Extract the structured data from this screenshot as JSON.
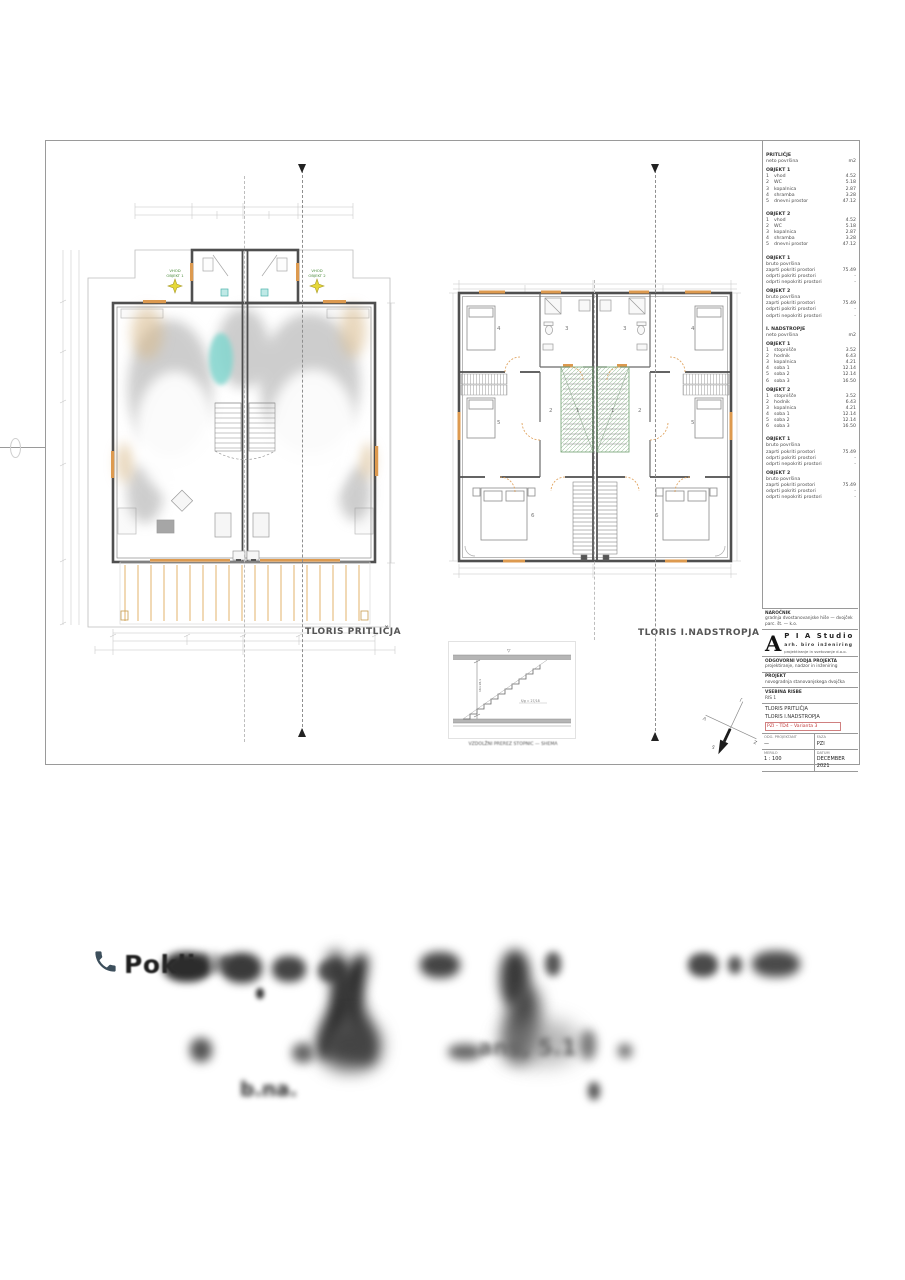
{
  "sheet": {
    "ground": {
      "title": "TLORIS PRITLIČJA",
      "entry1": "VHOD",
      "entry1b": "OBJEKT 1",
      "entry2": "VHOD",
      "entry2b": "OBJEKT 2"
    },
    "upper": {
      "title": "TLORIS I.NADSTROPJA",
      "rooms": [
        "1",
        "2",
        "3",
        "4",
        "5",
        "6"
      ]
    },
    "stair_detail": {
      "caption": "VZDOLŽNI PREREZ STOPNIC — SHEMA",
      "note": "š/g = 27/18",
      "dim_label": "16×18,1",
      "level_top": "▽"
    },
    "compass": {
      "n": "S",
      "e": "V",
      "s": "J",
      "w": "Z"
    }
  },
  "legend": {
    "sections": [
      {
        "lines": [
          {
            "t": "PRITLIČJE"
          },
          {
            "l": "neto površina",
            "v": "m2"
          },
          {
            "t": "OBJEKT 1"
          },
          {
            "n": "1",
            "l": "vhod",
            "v": "4.52"
          },
          {
            "n": "2",
            "l": "WC",
            "v": "5.18"
          },
          {
            "n": "3",
            "l": "kopalnica",
            "v": "2.87"
          },
          {
            "n": "4",
            "l": "shramba",
            "v": "3.28"
          },
          {
            "n": "5",
            "l": "dnevni prostor",
            "v": "47.12"
          }
        ]
      },
      {
        "lines": [
          {
            "t": "OBJEKT 2"
          },
          {
            "n": "1",
            "l": "vhod",
            "v": "4.52"
          },
          {
            "n": "2",
            "l": "WC",
            "v": "5.18"
          },
          {
            "n": "3",
            "l": "kopalnica",
            "v": "2.87"
          },
          {
            "n": "4",
            "l": "shramba",
            "v": "3.28"
          },
          {
            "n": "5",
            "l": "dnevni prostor",
            "v": "47.12"
          }
        ]
      },
      {
        "lines": [
          {
            "t": "OBJEKT 1"
          },
          {
            "l": "bruto površina"
          },
          {
            "l": "zaprti pokriti prostori",
            "v": "75.49"
          },
          {
            "l": "odprti pokriti prostori",
            "v": "-"
          },
          {
            "l": "odprti nepokriti prostori",
            "v": "-"
          },
          {
            "t": "OBJEKT 2"
          },
          {
            "l": "bruto površina"
          },
          {
            "l": "zaprti pokriti prostori",
            "v": "75.49"
          },
          {
            "l": "odprti pokriti prostori",
            "v": "-"
          },
          {
            "l": "odprti nepokriti prostori",
            "v": "-"
          }
        ]
      },
      {
        "lines": [
          {
            "t": "I. NADSTROPJE"
          },
          {
            "l": "neto površina",
            "v": "m2"
          },
          {
            "t": "OBJEKT 1"
          },
          {
            "n": "1",
            "l": "stopnišče",
            "v": "3.52"
          },
          {
            "n": "2",
            "l": "hodnik",
            "v": "6.43"
          },
          {
            "n": "3",
            "l": "kopalnica",
            "v": "4.21"
          },
          {
            "n": "4",
            "l": "soba 1",
            "v": "12.14"
          },
          {
            "n": "5",
            "l": "soba 2",
            "v": "12.14"
          },
          {
            "n": "6",
            "l": "soba 3",
            "v": "16.50"
          },
          {
            "t": "OBJEKT 2"
          },
          {
            "n": "1",
            "l": "stopnišče",
            "v": "3.52"
          },
          {
            "n": "2",
            "l": "hodnik",
            "v": "6.43"
          },
          {
            "n": "3",
            "l": "kopalnica",
            "v": "4.21"
          },
          {
            "n": "4",
            "l": "soba 1",
            "v": "12.14"
          },
          {
            "n": "5",
            "l": "soba 2",
            "v": "12.14"
          },
          {
            "n": "6",
            "l": "soba 3",
            "v": "16.50"
          }
        ]
      },
      {
        "lines": [
          {
            "t": "OBJEKT 1"
          },
          {
            "l": "bruto površina"
          },
          {
            "l": "zaprti pokriti prostori",
            "v": "75.49"
          },
          {
            "l": "odprti pokriti prostori",
            "v": "-"
          },
          {
            "l": "odprti nepokriti prostori",
            "v": "-"
          },
          {
            "t": "OBJEKT 2"
          },
          {
            "l": "bruto površina"
          },
          {
            "l": "zaprti pokriti prostori",
            "v": "75.49"
          },
          {
            "l": "odprti pokriti prostori",
            "v": "-"
          },
          {
            "l": "odprti nepokriti prostori",
            "v": "-"
          }
        ]
      }
    ]
  },
  "titleblock": {
    "blocks": [
      {
        "lines": [
          "NAROČNIK",
          "gradnja dvostanovanjske hiše — dvojček",
          "parc. št. — k.o."
        ]
      },
      {
        "logo": true,
        "letter": "A",
        "name": "P I A  Studio",
        "sub": "arh. biro inženiring",
        "line2": "projektiranje in svetovanje d.o.o."
      },
      {
        "lines": [
          "ODGOVORNI VODJA PROJEKTA",
          "projektiranje, nadzor in inženiring"
        ]
      },
      {
        "lines": [
          "PROJEKT",
          "novogradnja stanovanjskega dvojčka"
        ]
      },
      {
        "lines": [
          "VSEBINA RISBE",
          "RIS 1"
        ]
      },
      {
        "list": [
          "TLORIS PRITLIČJA",
          "TLORIS I.NADSTROPJA"
        ],
        "red": "PZI – TD4 – Varianta 3"
      },
      {
        "grid": [
          [
            "ODG. PROJEKTANT",
            "—"
          ],
          [
            "FAZA",
            "PZI"
          ],
          [
            "MERILO",
            "1 : 100"
          ],
          [
            "DATUM",
            "DECEMBER 2021"
          ]
        ]
      }
    ]
  },
  "contact": {
    "visible": "Pokli",
    "blurred": "čite",
    "frag2": "ans, 5.1",
    "frag3": "b.na."
  }
}
